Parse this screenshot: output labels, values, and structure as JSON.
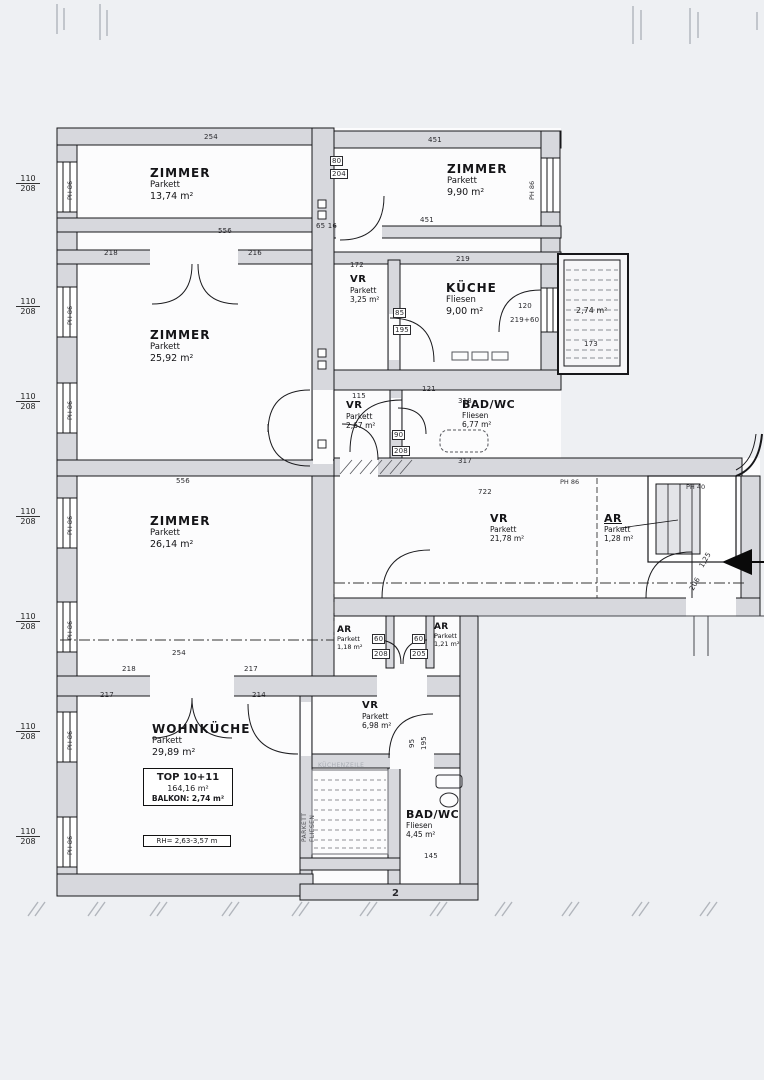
{
  "plan": {
    "type": "apartment-floor-plan",
    "unit": "TOP 10+11"
  },
  "rooms": [
    {
      "id": "zimmer-1",
      "name": "ZIMMER",
      "floor": "Parkett",
      "area": "13,74 m²"
    },
    {
      "id": "zimmer-2",
      "name": "ZIMMER",
      "floor": "Parkett",
      "area": "25,92 m²"
    },
    {
      "id": "vr-1",
      "name": "VR",
      "floor": "Parkett",
      "area": "3,25 m²"
    },
    {
      "id": "kueche",
      "name": "KÜCHE",
      "floor": "Fliesen",
      "area": "9,00 m²"
    },
    {
      "id": "zimmer-4",
      "name": "ZIMMER",
      "floor": "Parkett",
      "area": "9,90 m²"
    },
    {
      "id": "vr-2",
      "name": "VR",
      "floor": "Parkett",
      "area": "2,67 m²"
    },
    {
      "id": "bad-1",
      "name": "BAD/WC",
      "floor": "Fliesen",
      "area": "6,77 m²"
    },
    {
      "id": "zimmer-3",
      "name": "ZIMMER",
      "floor": "Parkett",
      "area": "26,14 m²"
    },
    {
      "id": "vr-3",
      "name": "VR",
      "floor": "Parkett",
      "area": "21,78 m²"
    },
    {
      "id": "ar-3",
      "name": "AR",
      "floor": "Parkett",
      "area": "1,28 m²"
    },
    {
      "id": "ar-1",
      "name": "AR",
      "floor": "Parkett",
      "area": "1,18 m²"
    },
    {
      "id": "ar-2",
      "name": "AR",
      "floor": "Parkett",
      "area": "1,21 m²"
    },
    {
      "id": "vr-4",
      "name": "VR",
      "floor": "Parkett",
      "area": "6,98 m²"
    },
    {
      "id": "wohnkueche",
      "name": "WOHNKÜCHE",
      "floor": "Parkett",
      "area": "29,89 m²"
    },
    {
      "id": "bad-2",
      "name": "BAD/WC",
      "floor": "Fliesen",
      "area": "4,45 m²"
    }
  ],
  "info_box": {
    "title": "TOP 10+11",
    "total_area": "164,16 m²",
    "balcony_line": "BALKON: 2,74 m²",
    "room_height": "RH= 2,63-3,57 m"
  },
  "balcony": {
    "area": "2,74 m²",
    "width_dim": "173"
  },
  "window": {
    "width": "110",
    "height": "208",
    "parapet": "PH 86"
  },
  "entry": {
    "parapet": "PH 40",
    "door_w": "1,25",
    "door_h": "206"
  },
  "annotations": {
    "kitchen_line": "KÜCHENZEILE",
    "floor_a": "PARKETT",
    "floor_b": "FLIESEN"
  },
  "dims": [
    {
      "t": "254"
    },
    {
      "t": "451"
    },
    {
      "t": "451"
    },
    {
      "t": "556"
    },
    {
      "t": "218"
    },
    {
      "t": "216"
    },
    {
      "t": "80"
    },
    {
      "t": "204"
    },
    {
      "t": "172"
    },
    {
      "t": "219"
    },
    {
      "t": "85"
    },
    {
      "t": "195"
    },
    {
      "t": "120"
    },
    {
      "t": "219+60"
    },
    {
      "t": "121"
    },
    {
      "t": "115"
    },
    {
      "t": "318"
    },
    {
      "t": "317"
    },
    {
      "t": "90"
    },
    {
      "t": "208"
    },
    {
      "t": "556"
    },
    {
      "t": "722"
    },
    {
      "t": "254"
    },
    {
      "t": "218"
    },
    {
      "t": "217"
    },
    {
      "t": "60"
    },
    {
      "t": "208"
    },
    {
      "t": "60"
    },
    {
      "t": "205"
    },
    {
      "t": "217"
    },
    {
      "t": "214"
    },
    {
      "t": "145"
    },
    {
      "t": "2"
    },
    {
      "t": "95"
    },
    {
      "t": "195"
    },
    {
      "t": "65 16"
    }
  ]
}
